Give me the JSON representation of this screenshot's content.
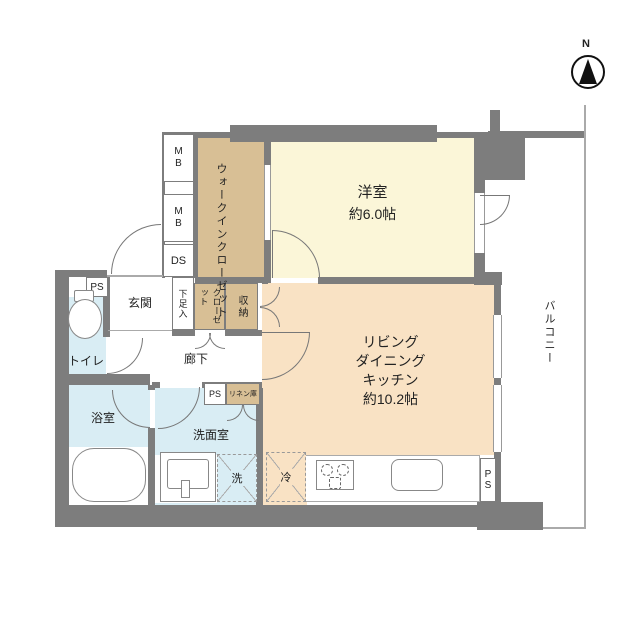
{
  "compass": {
    "north": "N"
  },
  "rooms": {
    "western": {
      "name": "洋室",
      "size": "約6.0帖"
    },
    "ldk": {
      "name1": "リビング",
      "name2": "ダイニング",
      "name3": "キッチン",
      "size": "約10.2帖"
    },
    "wic": {
      "name": "ウォークインクローゼット"
    },
    "entrance": {
      "name": "玄関"
    },
    "corridor": {
      "name": "廊下"
    },
    "toilet": {
      "name": "トイレ"
    },
    "bath": {
      "name": "浴室"
    },
    "washroom": {
      "name": "洗面室"
    },
    "balcony": {
      "name": "バルコニー"
    },
    "closet": {
      "name": "クローゼット"
    },
    "storage": {
      "name": "収納"
    },
    "shoe_cabinet": {
      "name": "下足入"
    },
    "linen": {
      "name": "リネン庫"
    }
  },
  "labels": {
    "meter_box_1": "MB",
    "meter_box_2": "MB",
    "duct_space": "DS",
    "pipe_space_toilet": "PS",
    "pipe_space_corridor": "PS",
    "pipe_space_kitchen": "PS",
    "washer": "洗",
    "fridge": "冷"
  },
  "colors": {
    "wall": "#7d7d7d",
    "room-cream": "#fbf6d8",
    "room-peach": "#f9e2c4",
    "room-tan": "#d8bf95",
    "room-blue": "#d9edf4",
    "text": "#222222"
  }
}
